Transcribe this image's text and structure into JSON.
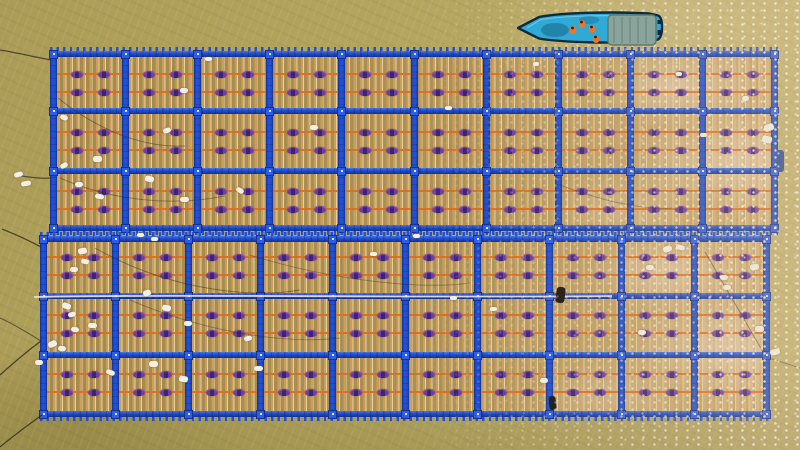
{
  "scene": {
    "title": "aerial-view-floating-aquaculture-rafts-with-workboat",
    "water": {
      "top_left": "#ab9c57",
      "mid": "#b5a660",
      "sun_side": "#c2b175",
      "bottom": "#a59849",
      "sparkle": "#fffdf2"
    },
    "raft_style": {
      "beam": "#2250d2",
      "beam_dark": "#15328f",
      "beam_light": "#4a77e8",
      "connector": "#2e5ce4",
      "connector_dot": "#dfe9ff",
      "pole": "#c99f5c",
      "pole_highlight": "#e9cf9d",
      "line_orange": "#dd6d1e",
      "bead_outer": "#6d3da0",
      "bead_core": "#3c2472",
      "beads_per_cell_per_row": 2,
      "float_rows_per_band": 2
    },
    "rafts": [
      {
        "id": "top",
        "x": 50,
        "y": 51,
        "w": 728,
        "h": 180,
        "cols": 10,
        "hbeams": [
          0,
          57,
          117,
          174
        ],
        "float_rows": [
          23,
          41,
          81,
          99,
          140,
          158
        ]
      },
      {
        "id": "bottom",
        "x": 40,
        "y": 236,
        "w": 730,
        "h": 181,
        "cols": 10,
        "hbeams": [
          0,
          57,
          116,
          175
        ],
        "float_rows": [
          21,
          39,
          79,
          97,
          138,
          156
        ]
      }
    ],
    "boat": {
      "x": 517,
      "y": 7,
      "w": 147,
      "h": 40,
      "hull": "#2fa9d6",
      "hull_dark": "#0d2b3c",
      "deck_shadow": "rgba(10,45,70,0.30)",
      "canopy": "#8ba49b",
      "canopy_dark": "#5c7a72",
      "crew_vest": "#ef7426",
      "crew_head": "#27221c",
      "crew": [
        [
          56,
          23
        ],
        [
          65,
          17
        ],
        [
          75,
          22
        ],
        [
          79,
          32
        ]
      ]
    },
    "debris_white": {
      "color": "#f2efe6",
      "items": [
        [
          14,
          172,
          9,
          5,
          -15
        ],
        [
          21,
          181,
          10,
          5,
          -10
        ],
        [
          60,
          115,
          8,
          5,
          20
        ],
        [
          93,
          156,
          9,
          6,
          0
        ],
        [
          60,
          163,
          8,
          5,
          -30
        ],
        [
          95,
          194,
          9,
          5,
          10
        ],
        [
          75,
          182,
          8,
          5,
          0
        ],
        [
          180,
          88,
          8,
          5,
          0
        ],
        [
          163,
          128,
          8,
          5,
          -20
        ],
        [
          145,
          176,
          9,
          6,
          15
        ],
        [
          180,
          197,
          9,
          5,
          0
        ],
        [
          236,
          188,
          8,
          5,
          30
        ],
        [
          310,
          125,
          8,
          5,
          0
        ],
        [
          205,
          57,
          7,
          4,
          0
        ],
        [
          445,
          106,
          7,
          4,
          0
        ],
        [
          533,
          62,
          6,
          4,
          0
        ],
        [
          676,
          72,
          6,
          4,
          0
        ],
        [
          700,
          133,
          7,
          4,
          0
        ],
        [
          742,
          96,
          7,
          5,
          0
        ],
        [
          764,
          124,
          10,
          7,
          -20
        ],
        [
          762,
          136,
          10,
          7,
          10
        ],
        [
          78,
          248,
          9,
          6,
          -10
        ],
        [
          81,
          259,
          8,
          5,
          15
        ],
        [
          70,
          267,
          8,
          5,
          0
        ],
        [
          62,
          303,
          9,
          6,
          20
        ],
        [
          68,
          312,
          8,
          5,
          -15
        ],
        [
          88,
          323,
          9,
          5,
          0
        ],
        [
          71,
          327,
          8,
          5,
          10
        ],
        [
          48,
          341,
          9,
          6,
          -25
        ],
        [
          58,
          346,
          8,
          5,
          5
        ],
        [
          35,
          360,
          8,
          5,
          0
        ],
        [
          106,
          370,
          9,
          5,
          20
        ],
        [
          149,
          361,
          9,
          6,
          0
        ],
        [
          143,
          290,
          8,
          6,
          -20
        ],
        [
          162,
          305,
          9,
          6,
          10
        ],
        [
          184,
          321,
          8,
          5,
          0
        ],
        [
          244,
          336,
          8,
          5,
          -15
        ],
        [
          254,
          366,
          9,
          5,
          0
        ],
        [
          179,
          376,
          9,
          6,
          10
        ],
        [
          137,
          233,
          7,
          4,
          0
        ],
        [
          151,
          237,
          7,
          4,
          0
        ],
        [
          370,
          252,
          7,
          4,
          0
        ],
        [
          413,
          234,
          7,
          4,
          0
        ],
        [
          450,
          296,
          7,
          4,
          0
        ],
        [
          490,
          307,
          7,
          4,
          0
        ],
        [
          540,
          378,
          8,
          5,
          0
        ],
        [
          638,
          330,
          8,
          5,
          0
        ],
        [
          663,
          246,
          9,
          6,
          -20
        ],
        [
          676,
          245,
          9,
          5,
          15
        ],
        [
          646,
          265,
          8,
          5,
          0
        ],
        [
          720,
          275,
          8,
          5,
          0
        ],
        [
          750,
          264,
          9,
          6,
          -10
        ],
        [
          723,
          285,
          8,
          5,
          0
        ],
        [
          755,
          326,
          9,
          6,
          0
        ],
        [
          770,
          349,
          10,
          6,
          -15
        ]
      ]
    },
    "dark_floats": [
      [
        556,
        287,
        9,
        16,
        8,
        "#1c1610"
      ],
      [
        549,
        396,
        7,
        14,
        -6,
        "#12161c"
      ],
      [
        776,
        150,
        8,
        22,
        0,
        "#2b4a9c"
      ]
    ],
    "ropes": {
      "dark": "#2e2a1c",
      "white": "#ece6d8",
      "paths": [
        {
          "d": "M51,60 C34,57 14,52 0,50",
          "c": "dark",
          "w": 1.3,
          "o": 0.75
        },
        {
          "d": "M51,178 C40,179 30,177 21,176",
          "c": "dark",
          "w": 1.2,
          "o": 0.7
        },
        {
          "d": "M41,247 C28,240 12,233 2,229",
          "c": "dark",
          "w": 1.3,
          "o": 0.75
        },
        {
          "d": "M41,341 C26,352 10,366 0,375",
          "c": "dark",
          "w": 1.3,
          "o": 0.8
        },
        {
          "d": "M42,415 C28,425 12,437 0,447",
          "c": "dark",
          "w": 1.3,
          "o": 0.8
        },
        {
          "d": "M0,318 C14,324 28,333 41,341",
          "c": "dark",
          "w": 1.1,
          "o": 0.6
        },
        {
          "d": "M58,98 C95,128 140,148 185,146",
          "c": "dark",
          "w": 1,
          "o": 0.45
        },
        {
          "d": "M60,178 C110,200 170,207 225,196",
          "c": "dark",
          "w": 1,
          "o": 0.4
        },
        {
          "d": "M95,248 C160,285 240,300 300,290",
          "c": "dark",
          "w": 1,
          "o": 0.45
        },
        {
          "d": "M130,300 C200,330 280,345 340,338",
          "c": "dark",
          "w": 1,
          "o": 0.35
        },
        {
          "d": "M250,255 C330,280 420,290 470,283",
          "c": "dark",
          "w": 1,
          "o": 0.35
        },
        {
          "d": "M560,185 C600,200 640,210 672,208",
          "c": "dark",
          "w": 1,
          "o": 0.35
        },
        {
          "d": "M705,252 L766,357",
          "c": "dark",
          "w": 1,
          "o": 0.5
        },
        {
          "d": "M766,357 L800,368",
          "c": "dark",
          "w": 1,
          "o": 0.45
        },
        {
          "d": "M34,297 C180,294 430,298 612,296",
          "c": "white",
          "w": 1.8,
          "o": 0.9
        }
      ]
    }
  }
}
